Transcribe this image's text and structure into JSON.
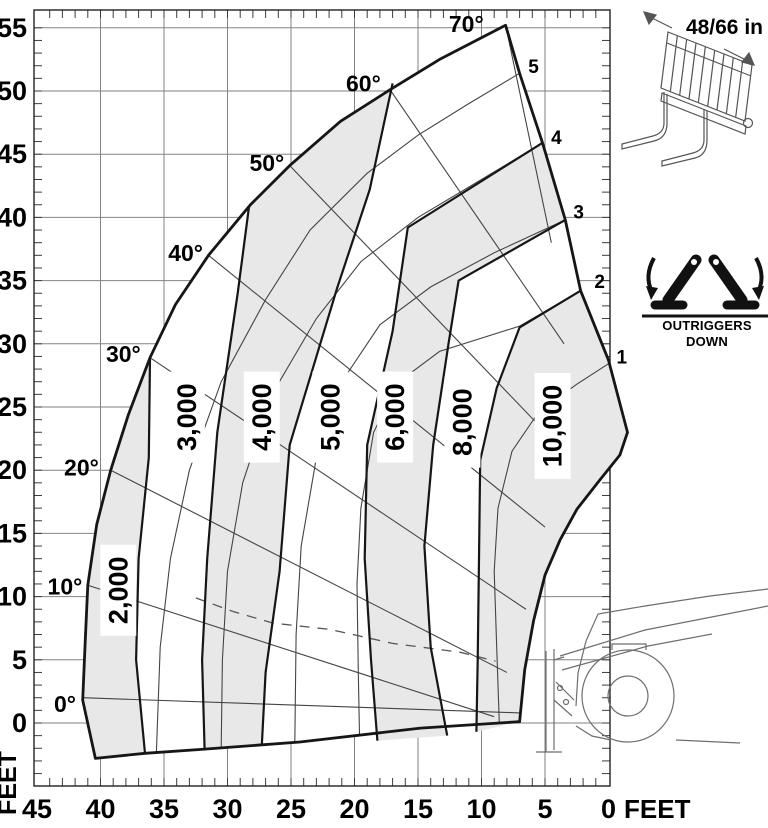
{
  "chart_data": {
    "type": "area",
    "title": "Telehandler load capacity chart (capacity zones by boom angle and extension)",
    "x_axis": {
      "label": "FEET",
      "range": [
        45,
        0
      ],
      "major_ticks": [
        45,
        40,
        35,
        30,
        25,
        20,
        15,
        10,
        5,
        0
      ],
      "minor_step": 1,
      "grid": true
    },
    "y_axis": {
      "label": "FEET",
      "range": [
        0,
        55
      ],
      "major_ticks": [
        0,
        5,
        10,
        15,
        20,
        25,
        30,
        35,
        40,
        45,
        50,
        55
      ],
      "minor_step": 1,
      "grid": true
    },
    "capacity_zones": [
      {
        "label": "2,000",
        "shaded": true,
        "label_pos": [
          38.6,
          10.5
        ]
      },
      {
        "label": "3,000",
        "shaded": false,
        "label_pos": [
          33.2,
          24.2
        ]
      },
      {
        "label": "4,000",
        "shaded": true,
        "label_pos": [
          27.3,
          24.2
        ]
      },
      {
        "label": "5,000",
        "shaded": false,
        "label_pos": [
          21.9,
          24.2
        ]
      },
      {
        "label": "6,000",
        "shaded": true,
        "label_pos": [
          16.8,
          24.2
        ]
      },
      {
        "label": "8,000",
        "shaded": false,
        "label_pos": [
          11.5,
          23.8
        ]
      },
      {
        "label": "10,000",
        "shaded": true,
        "label_pos": [
          4.4,
          23.5
        ]
      }
    ],
    "envelope_outline": [
      [
        40.4,
        -2.8
      ],
      [
        41.4,
        1.8
      ],
      [
        41.2,
        6.6
      ],
      [
        41.0,
        10.9
      ],
      [
        40.3,
        15.7
      ],
      [
        39.2,
        20.0
      ],
      [
        37.8,
        24.4
      ],
      [
        36.1,
        28.9
      ],
      [
        34.1,
        33.1
      ],
      [
        31.5,
        37.0
      ],
      [
        28.2,
        41.0
      ],
      [
        25.1,
        44.1
      ],
      [
        21.1,
        47.6
      ],
      [
        17.2,
        50.1
      ],
      [
        13.3,
        52.5
      ],
      [
        8.1,
        55.2
      ],
      [
        7.0,
        51.4
      ],
      [
        5.2,
        45.9
      ],
      [
        3.4,
        39.8
      ],
      [
        2.2,
        34.2
      ],
      [
        0.0,
        28.7
      ],
      [
        -1.5,
        23.0
      ],
      [
        -0.9,
        21.2
      ],
      [
        0.7,
        19.2
      ],
      [
        2.5,
        16.9
      ],
      [
        3.8,
        14.5
      ],
      [
        5.0,
        11.7
      ],
      [
        5.9,
        8.1
      ],
      [
        6.6,
        4.2
      ],
      [
        7.0,
        0.1
      ],
      [
        14.8,
        -0.4
      ],
      [
        24.3,
        -1.5
      ],
      [
        32.2,
        -2.1
      ],
      [
        36.5,
        -2.4
      ]
    ],
    "zone_dividers": [
      [
        [
          36.5,
          -2.4
        ],
        [
          37.2,
          5.0
        ],
        [
          37.0,
          13.0
        ],
        [
          36.2,
          21.0
        ],
        [
          36.1,
          28.9
        ]
      ],
      [
        [
          31.8,
          -2.1
        ],
        [
          32.0,
          5.0
        ],
        [
          31.6,
          13.0
        ],
        [
          30.8,
          23.0
        ],
        [
          29.2,
          34.0
        ],
        [
          28.3,
          40.9
        ]
      ],
      [
        [
          27.3,
          -1.8
        ],
        [
          27.0,
          4.0
        ],
        [
          25.9,
          12.0
        ],
        [
          25.1,
          22.0
        ],
        [
          21.4,
          34.3
        ],
        [
          18.8,
          42.2
        ],
        [
          17.0,
          50.6
        ]
      ],
      [
        [
          18.2,
          -1.4
        ],
        [
          18.7,
          5.0
        ],
        [
          19.2,
          13.0
        ],
        [
          19.0,
          22.0
        ],
        [
          17.0,
          31.0
        ],
        [
          15.8,
          39.2
        ],
        [
          5.2,
          45.9
        ]
      ],
      [
        [
          12.7,
          -1.0
        ],
        [
          14.0,
          6.0
        ],
        [
          14.5,
          14.0
        ],
        [
          13.8,
          22.0
        ],
        [
          12.6,
          30.0
        ],
        [
          11.8,
          35.0
        ],
        [
          3.4,
          39.8
        ]
      ],
      [
        [
          10.4,
          -0.7
        ],
        [
          10.3,
          5.0
        ],
        [
          10.2,
          13.0
        ],
        [
          10.1,
          20.8
        ],
        [
          8.8,
          26.5
        ],
        [
          7.0,
          31.3
        ],
        [
          2.2,
          34.2
        ]
      ]
    ],
    "shaded_polygons": [
      [
        [
          40.4,
          -2.8
        ],
        [
          41.4,
          1.8
        ],
        [
          41.2,
          6.6
        ],
        [
          41.0,
          10.9
        ],
        [
          40.3,
          15.7
        ],
        [
          39.2,
          20.0
        ],
        [
          37.8,
          24.4
        ],
        [
          36.1,
          28.9
        ],
        [
          36.2,
          21.0
        ],
        [
          37.0,
          13.0
        ],
        [
          37.2,
          5.0
        ],
        [
          36.5,
          -2.4
        ]
      ],
      [
        [
          31.8,
          -2.1
        ],
        [
          32.0,
          5.0
        ],
        [
          31.6,
          13.0
        ],
        [
          30.8,
          23.0
        ],
        [
          29.2,
          34.0
        ],
        [
          28.3,
          40.9
        ],
        [
          25.1,
          44.1
        ],
        [
          21.1,
          47.6
        ],
        [
          17.2,
          50.1
        ],
        [
          17.0,
          50.6
        ],
        [
          18.8,
          42.2
        ],
        [
          21.4,
          34.3
        ],
        [
          25.1,
          22.0
        ],
        [
          25.9,
          12.0
        ],
        [
          27.0,
          4.0
        ],
        [
          27.3,
          -1.8
        ]
      ],
      [
        [
          12.7,
          -1.0
        ],
        [
          14.0,
          6.0
        ],
        [
          14.5,
          14.0
        ],
        [
          13.8,
          22.0
        ],
        [
          12.6,
          30.0
        ],
        [
          11.8,
          35.0
        ],
        [
          3.4,
          39.8
        ],
        [
          5.2,
          45.9
        ],
        [
          15.8,
          39.2
        ],
        [
          17.0,
          31.0
        ],
        [
          19.0,
          22.0
        ],
        [
          19.2,
          13.0
        ],
        [
          18.7,
          5.0
        ],
        [
          18.2,
          -1.4
        ]
      ],
      [
        [
          10.4,
          -0.7
        ],
        [
          10.3,
          5.0
        ],
        [
          10.2,
          13.0
        ],
        [
          10.1,
          20.8
        ],
        [
          8.8,
          26.5
        ],
        [
          7.0,
          31.3
        ],
        [
          2.2,
          34.2
        ],
        [
          0.0,
          28.7
        ],
        [
          -1.5,
          23.0
        ],
        [
          -0.9,
          21.2
        ],
        [
          0.7,
          19.2
        ],
        [
          2.5,
          16.9
        ],
        [
          3.8,
          14.5
        ],
        [
          5.0,
          11.7
        ],
        [
          5.9,
          8.1
        ],
        [
          6.6,
          4.2
        ],
        [
          7.0,
          0.1
        ]
      ]
    ],
    "boom_angles": [
      {
        "label": "0°",
        "label_pos": [
          42.8,
          1.5
        ],
        "line": [
          [
            7.0,
            0.8
          ],
          [
            41.4,
            2.0
          ]
        ]
      },
      {
        "label": "10°",
        "label_pos": [
          42.8,
          10.8
        ],
        "line": [
          [
            9.0,
            0.5
          ],
          [
            41.0,
            10.9
          ]
        ]
      },
      {
        "label": "20°",
        "label_pos": [
          41.5,
          20.2
        ],
        "line": [
          [
            8.0,
            4.0
          ],
          [
            39.2,
            20.0
          ]
        ]
      },
      {
        "label": "30°",
        "label_pos": [
          38.2,
          29.2
        ],
        "line": [
          [
            6.5,
            9.0
          ],
          [
            36.1,
            28.9
          ]
        ]
      },
      {
        "label": "40°",
        "label_pos": [
          33.3,
          37.2
        ],
        "line": [
          [
            5.0,
            15.5
          ],
          [
            31.5,
            37.0
          ]
        ]
      },
      {
        "label": "50°",
        "label_pos": [
          26.9,
          44.3
        ],
        "line": [
          [
            4.0,
            22.0
          ],
          [
            25.1,
            44.1
          ]
        ]
      },
      {
        "label": "60°",
        "label_pos": [
          19.3,
          50.6
        ],
        "line": [
          [
            3.5,
            30.0
          ],
          [
            17.2,
            50.1
          ]
        ]
      },
      {
        "label": "70°",
        "label_pos": [
          11.2,
          55.3
        ],
        "line": [
          [
            4.5,
            38.0
          ],
          [
            8.1,
            55.2
          ]
        ]
      }
    ],
    "extension_arcs": [
      {
        "label": "1",
        "label_pos": [
          -1.05,
          28.9
        ],
        "points": [
          [
            -0.9,
            29.0
          ],
          [
            2.5,
            26.8
          ],
          [
            5.5,
            24.6
          ],
          [
            7.6,
            21.5
          ],
          [
            8.7,
            17.0
          ],
          [
            9.0,
            12.0
          ],
          [
            8.8,
            6.0
          ],
          [
            8.6,
            0.0
          ]
        ]
      },
      {
        "label": "2",
        "label_pos": [
          0.7,
          34.9
        ],
        "points": [
          [
            2.2,
            34.2
          ],
          [
            7.0,
            31.4
          ],
          [
            13.3,
            29.4
          ],
          [
            16.5,
            27.0
          ],
          [
            18.5,
            23.0
          ],
          [
            19.5,
            17.0
          ],
          [
            19.8,
            11.0
          ],
          [
            19.7,
            4.0
          ],
          [
            19.6,
            -1.4
          ]
        ]
      },
      {
        "label": "3",
        "label_pos": [
          2.35,
          40.4
        ],
        "points": [
          [
            3.4,
            39.8
          ],
          [
            9.0,
            37.2
          ],
          [
            14.0,
            34.5
          ],
          [
            18.0,
            31.5
          ],
          [
            21.0,
            27.0
          ],
          [
            23.0,
            21.0
          ],
          [
            24.2,
            14.0
          ],
          [
            24.6,
            7.0
          ],
          [
            24.7,
            -1.7
          ]
        ]
      },
      {
        "label": "4",
        "label_pos": [
          4.1,
          46.3
        ],
        "points": [
          [
            5.2,
            45.9
          ],
          [
            10.0,
            43.0
          ],
          [
            15.0,
            40.0
          ],
          [
            19.5,
            36.5
          ],
          [
            23.0,
            32.0
          ],
          [
            26.5,
            26.0
          ],
          [
            28.8,
            19.0
          ],
          [
            30.0,
            12.0
          ],
          [
            30.4,
            5.0
          ],
          [
            30.5,
            -2.0
          ]
        ]
      },
      {
        "label": "5",
        "label_pos": [
          5.9,
          51.9
        ],
        "points": [
          [
            7.0,
            51.4
          ],
          [
            11.0,
            49.0
          ],
          [
            15.0,
            46.5
          ],
          [
            19.0,
            43.5
          ],
          [
            23.5,
            39.0
          ],
          [
            27.0,
            33.5
          ],
          [
            30.5,
            27.0
          ],
          [
            33.0,
            20.0
          ],
          [
            34.5,
            13.0
          ],
          [
            35.3,
            6.0
          ],
          [
            35.6,
            -2.3
          ]
        ]
      }
    ],
    "dashed_curve": [
      [
        32.5,
        9.9
      ],
      [
        29.5,
        8.8
      ],
      [
        26.4,
        7.9
      ],
      [
        21.9,
        7.4
      ],
      [
        17.0,
        6.3
      ],
      [
        11.7,
        5.6
      ],
      [
        8.9,
        4.9
      ]
    ],
    "colors": {
      "zone_fill": "#e8e8e8",
      "grid": "#828282",
      "heavy_line": "#161616",
      "thin_line": "#444444",
      "icon_line": "#6e6e6e",
      "text": "#000000"
    }
  },
  "side_panel": {
    "fork_icon_label": "48/66 in",
    "outriggers_label": "OUTRIGGERS",
    "outriggers_sublabel": "DOWN"
  },
  "icons": {
    "fork_attachment": "pallet-fork-attachment-icon",
    "outriggers": "outriggers-down-icon",
    "machine": "telehandler-silhouette-icon"
  }
}
